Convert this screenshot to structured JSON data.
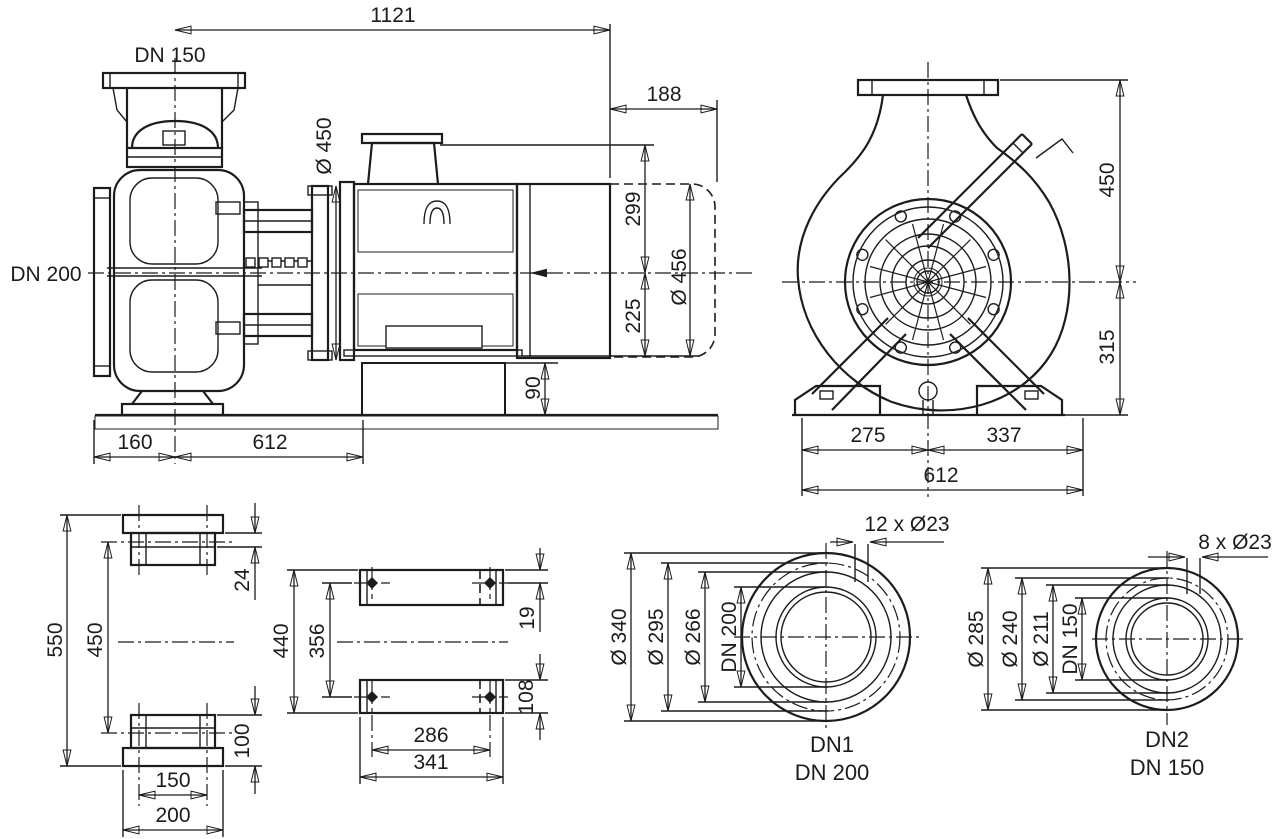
{
  "colors": {
    "line": "#1c1c1c",
    "background": "#ffffff"
  },
  "drawing": {
    "side_view": {
      "suction_label": "DN 150",
      "discharge_label": "DN 200",
      "dim_total_length": "1121",
      "dim_motor_overhang": "188",
      "dim_lantern_diameter": "Ø 450",
      "dim_axis_to_top": "299",
      "dim_axis_to_base": "225",
      "dim_motor_diameter": "Ø 456",
      "dim_foundation_height": "90",
      "dim_flange_to_axis": "160",
      "dim_base_length": "612"
    },
    "front_view": {
      "dim_axis_to_flange_top": "450",
      "dim_axis_to_base": "315",
      "dim_center_to_left_foot": "275",
      "dim_center_to_right_foot": "337",
      "dim_base_width": "612"
    },
    "suction_flange_section": {
      "dim_overall_height": "550",
      "dim_bolt_height": "450",
      "dim_flange_thickness": "24",
      "dim_foot_height": "100",
      "dim_bolt_spacing": "150",
      "dim_flange_width": "200"
    },
    "baseplate_view": {
      "dim_overall_height": "440",
      "dim_bolt_spacing_v": "356",
      "dim_edge_to_bolt_top": "19",
      "dim_edge_to_bolt_bottom": "108",
      "dim_bolt_spacing_h": "286",
      "dim_overall_width": "341"
    },
    "dn1_flange": {
      "bolt_note": "12 x Ø23",
      "dim_outer_diameter": "Ø 340",
      "dim_bolt_circle": "Ø 295",
      "dim_raised_face": "Ø 266",
      "dim_bore": "DN 200",
      "port_id": "DN1",
      "port_size": "DN 200"
    },
    "dn2_flange": {
      "bolt_note": "8 x Ø23",
      "dim_outer_diameter": "Ø 285",
      "dim_bolt_circle": "Ø 240",
      "dim_raised_face": "Ø 211",
      "dim_bore": "DN 150",
      "port_id": "DN2",
      "port_size": "DN 150"
    }
  }
}
